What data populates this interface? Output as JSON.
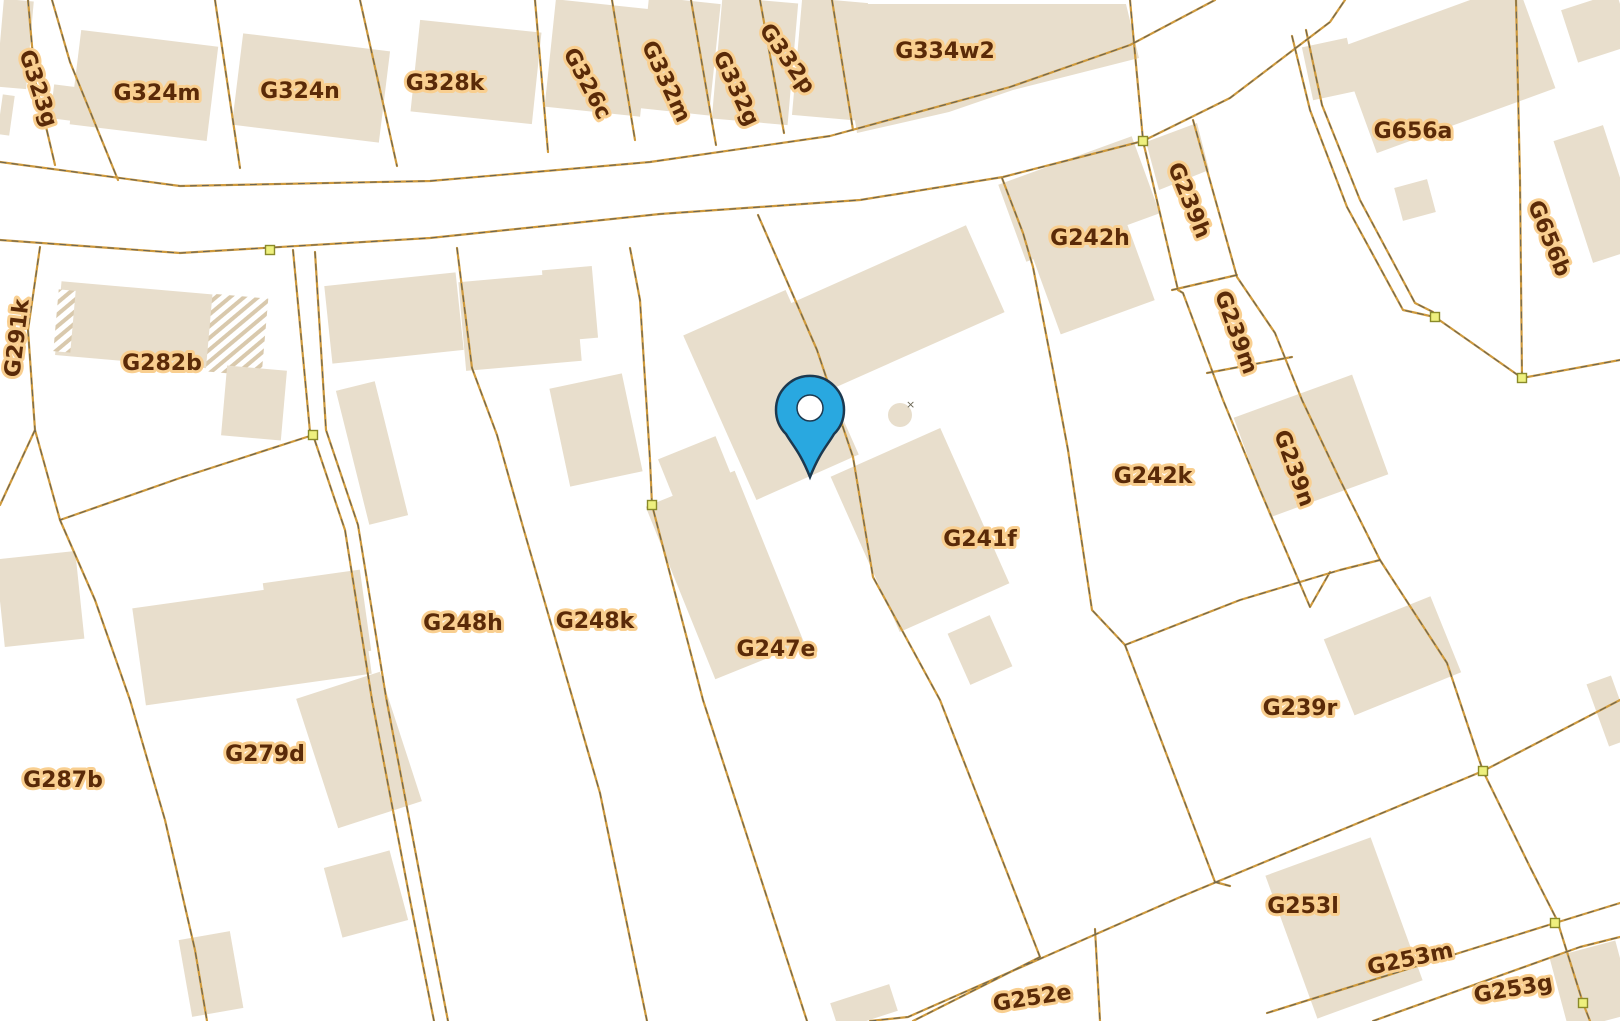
{
  "map": {
    "type": "cadastral-parcel-map",
    "background": "#ffffff",
    "colors": {
      "building": "#e8decc",
      "buildingHatchStripe": "#d9c9ad",
      "lineTan": "#cf9a3d",
      "lineDark": "#6a6553",
      "nodeFill": "#eef07e",
      "nodeStroke": "#8a8a2a",
      "labelText": "#5a2a08",
      "labelHalo": "#f9cf90",
      "pinFill": "#29a8e0",
      "pinStroke": "#1c3950",
      "pinHole": "#ffffff",
      "roundStructureMark": "#6a6553"
    },
    "parcel_labels": [
      {
        "text": "G323g",
        "x": 39,
        "y": 88,
        "rot": 72
      },
      {
        "text": "G324m",
        "x": 157,
        "y": 92,
        "rot": 0
      },
      {
        "text": "G324n",
        "x": 300,
        "y": 90,
        "rot": 0
      },
      {
        "text": "G328k",
        "x": 445,
        "y": 82,
        "rot": 0
      },
      {
        "text": "G326c",
        "x": 588,
        "y": 83,
        "rot": 62
      },
      {
        "text": "G332m",
        "x": 667,
        "y": 81,
        "rot": 65
      },
      {
        "text": "G332g",
        "x": 737,
        "y": 88,
        "rot": 65
      },
      {
        "text": "G332p",
        "x": 788,
        "y": 58,
        "rot": 55
      },
      {
        "text": "G334w2",
        "x": 945,
        "y": 50,
        "rot": 0
      },
      {
        "text": "G656a",
        "x": 1413,
        "y": 130,
        "rot": 0
      },
      {
        "text": "G656b",
        "x": 1550,
        "y": 238,
        "rot": 68
      },
      {
        "text": "G239h",
        "x": 1190,
        "y": 200,
        "rot": 68
      },
      {
        "text": "G242h",
        "x": 1090,
        "y": 237,
        "rot": 0
      },
      {
        "text": "G239m",
        "x": 1237,
        "y": 332,
        "rot": 70
      },
      {
        "text": "G242k",
        "x": 1153,
        "y": 475,
        "rot": 0
      },
      {
        "text": "G239n",
        "x": 1295,
        "y": 468,
        "rot": 70
      },
      {
        "text": "G241f",
        "x": 980,
        "y": 538,
        "rot": 0
      },
      {
        "text": "G291k",
        "x": 16,
        "y": 338,
        "rot": -83
      },
      {
        "text": "G282b",
        "x": 162,
        "y": 362,
        "rot": 0
      },
      {
        "text": "G248h",
        "x": 463,
        "y": 622,
        "rot": 0
      },
      {
        "text": "G248k",
        "x": 595,
        "y": 620,
        "rot": 0
      },
      {
        "text": "G247e",
        "x": 776,
        "y": 648,
        "rot": 0
      },
      {
        "text": "G287b",
        "x": 63,
        "y": 779,
        "rot": 0
      },
      {
        "text": "G279d",
        "x": 265,
        "y": 753,
        "rot": 0
      },
      {
        "text": "G239r",
        "x": 1300,
        "y": 707,
        "rot": 0
      },
      {
        "text": "G253l",
        "x": 1303,
        "y": 905,
        "rot": 0
      },
      {
        "text": "G253m",
        "x": 1410,
        "y": 958,
        "rot": -12
      },
      {
        "text": "G253g",
        "x": 1513,
        "y": 988,
        "rot": -10
      },
      {
        "text": "G252e",
        "x": 1032,
        "y": 997,
        "rot": -9
      }
    ],
    "vertex_nodes": [
      {
        "x": 270,
        "y": 250
      },
      {
        "x": 313,
        "y": 435
      },
      {
        "x": 652,
        "y": 505
      },
      {
        "x": 1143,
        "y": 141
      },
      {
        "x": 1435,
        "y": 317
      },
      {
        "x": 1522,
        "y": 378
      },
      {
        "x": 1483,
        "y": 771
      },
      {
        "x": 1555,
        "y": 923
      },
      {
        "x": 1583,
        "y": 1003
      }
    ],
    "pin": {
      "x": 810,
      "y": 410,
      "tipY": 477,
      "headRadius": 34,
      "holeRadius": 13
    },
    "round_structure": {
      "x": 900,
      "y": 415,
      "r": 12,
      "mark": "×"
    }
  }
}
